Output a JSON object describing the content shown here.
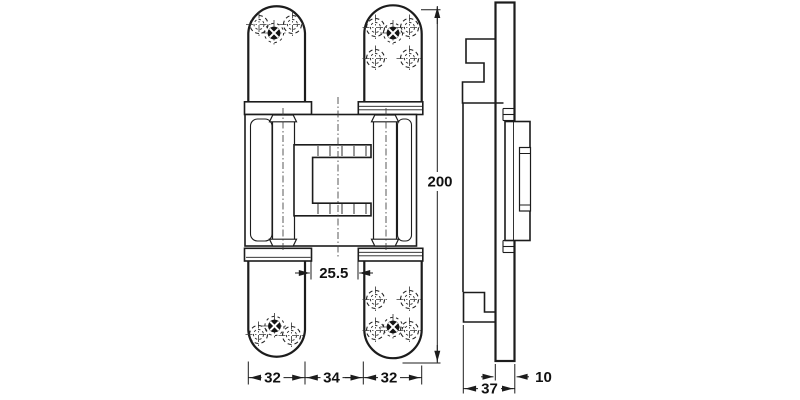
{
  "drawing": {
    "type": "technical-drawing",
    "subject": "concealed-hinge-front-and-side-elevation"
  },
  "dimensions": {
    "total_height": "200",
    "flange_gap": "25.5",
    "bottom_row": [
      "32",
      "34",
      "32"
    ],
    "side_total_depth": "37",
    "side_plate_offset": "10"
  },
  "colors": {
    "background": "#ffffff",
    "line": "#1c1c1c",
    "centerline": "#3c3c3c"
  }
}
